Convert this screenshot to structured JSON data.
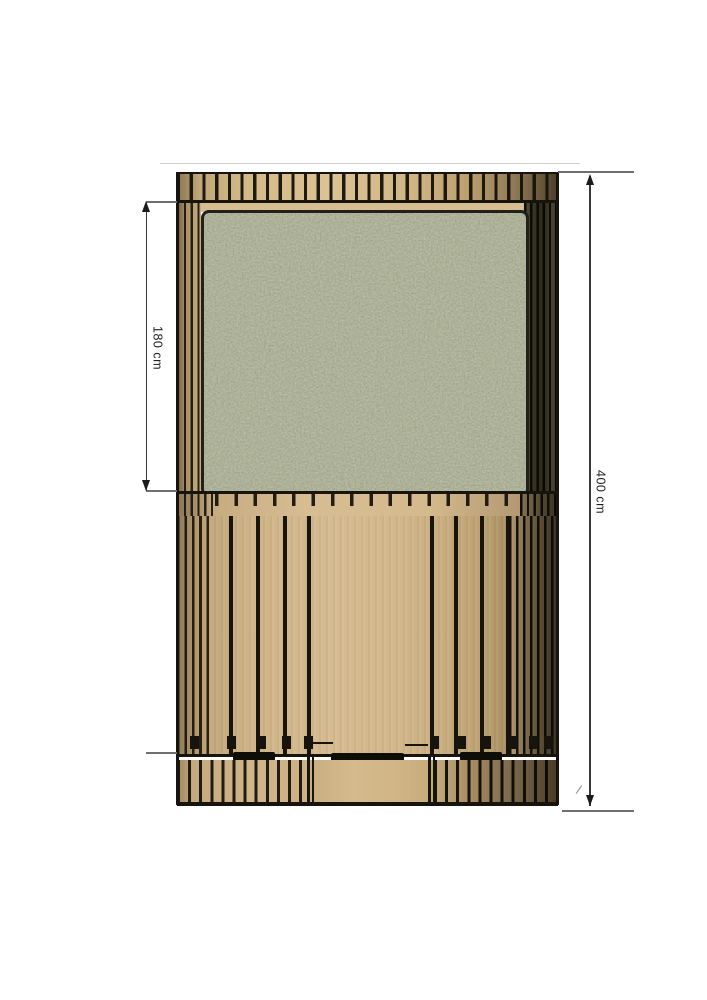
{
  "page": {
    "background": "#ffffff"
  },
  "drawing": {
    "kind": "technical-plan-top-view",
    "labels": {
      "dim_partial": "180 cm",
      "dim_total": "400 cm"
    },
    "colors": {
      "line": "#17140d",
      "dim_line": "#3a3a3a",
      "text": "#1f1f1f",
      "wood_light": "#d5bb8f",
      "wood_mid": "#c3a87c",
      "wood_dark": "#4e4330",
      "roof_green": "#6e7557"
    }
  }
}
